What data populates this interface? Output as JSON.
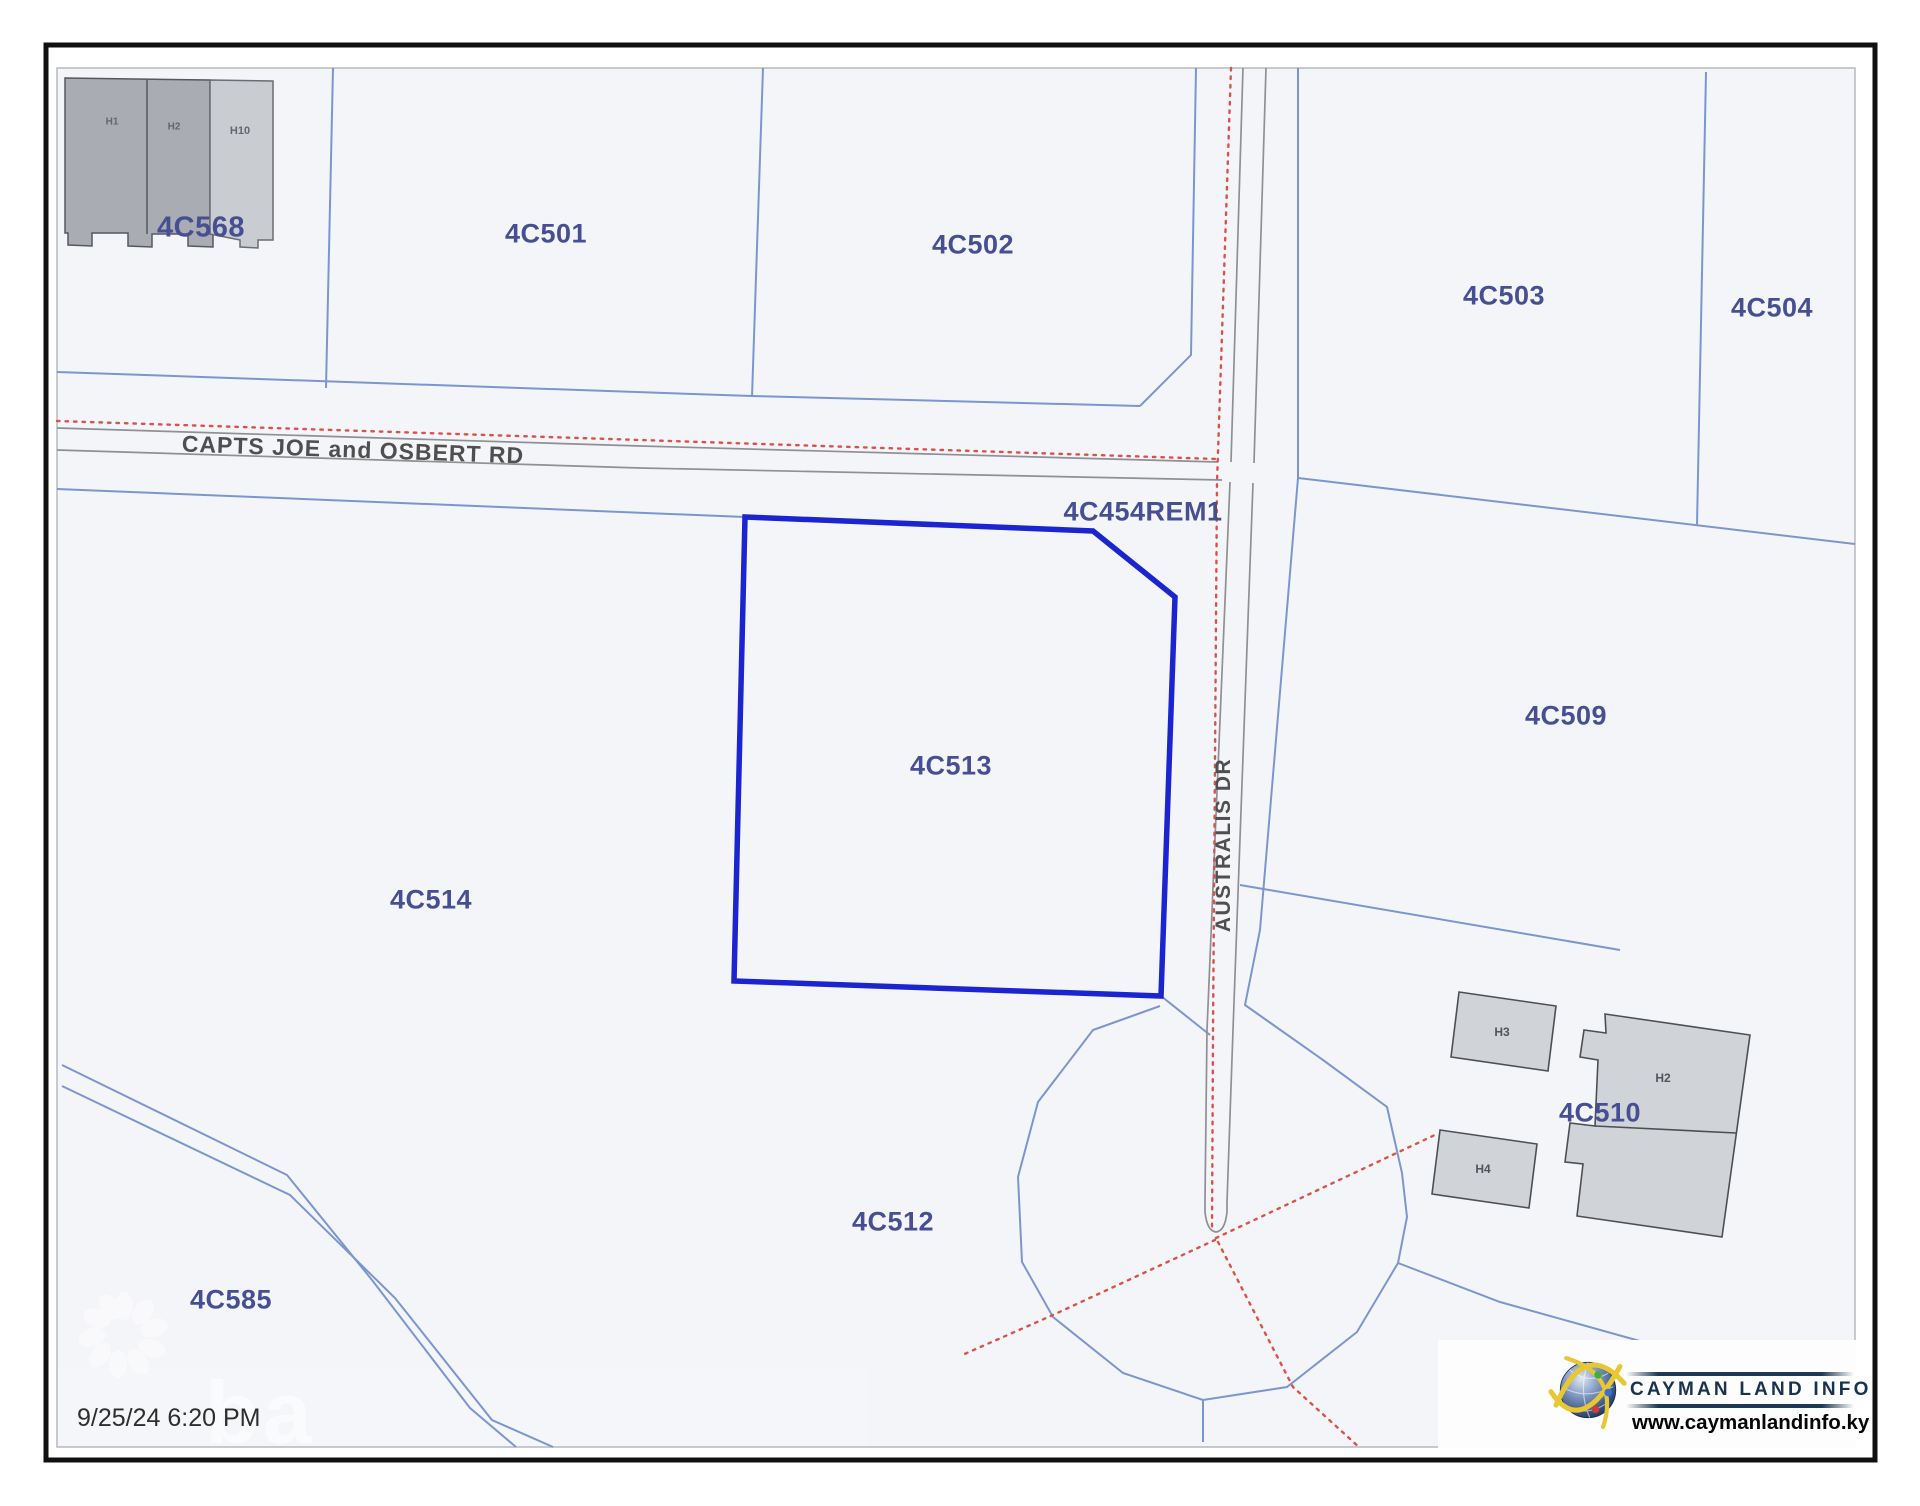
{
  "map": {
    "selected_parcel": "4C513",
    "parcels": [
      {
        "id": "4C568"
      },
      {
        "id": "4C501"
      },
      {
        "id": "4C502"
      },
      {
        "id": "4C503"
      },
      {
        "id": "4C504"
      },
      {
        "id": "4C454REM1"
      },
      {
        "id": "4C509"
      },
      {
        "id": "4C513"
      },
      {
        "id": "4C514"
      },
      {
        "id": "4C510"
      },
      {
        "id": "4C512"
      },
      {
        "id": "4C585"
      },
      {
        "id": "4C511"
      }
    ],
    "roads": [
      {
        "name": "CAPTS JOE and OSBERT RD"
      },
      {
        "name": "AUSTRALIS DR"
      }
    ],
    "buildings": [
      {
        "id": "H1"
      },
      {
        "id": "H2"
      },
      {
        "id": "H10"
      },
      {
        "id": "H3"
      },
      {
        "id": "H2"
      },
      {
        "id": "H4"
      }
    ],
    "colors": {
      "selected_outline": "#1b24cf",
      "boundary_blue": "#7b96cf",
      "survey_red": "#d9534a",
      "label_blue": "#474f93",
      "road_gray": "#8f9094"
    }
  },
  "footer": {
    "timestamp": "9/25/24 6:20 PM"
  },
  "logo": {
    "brand": "CAYMAN LAND INFO",
    "url": "www.caymanlandinfo.ky"
  },
  "watermark": {
    "text": "ba"
  }
}
